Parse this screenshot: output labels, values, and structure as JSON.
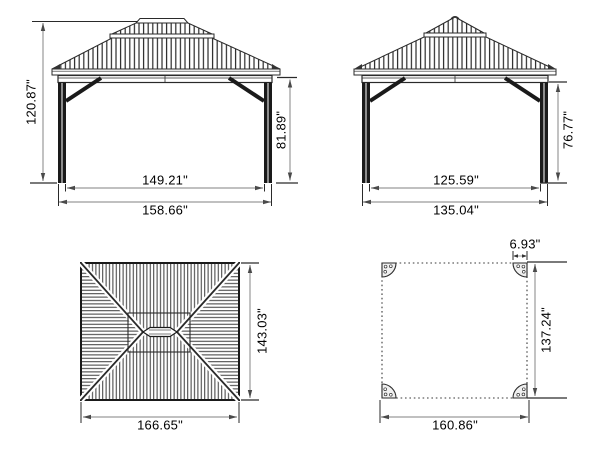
{
  "title": "Gazebo dimension drawing (four orthographic views)",
  "views": {
    "front": {
      "name": "front elevation",
      "total_height": "120.87\"",
      "post_height": "81.89\"",
      "inner_width": "149.21\"",
      "outer_width": "158.66\""
    },
    "side": {
      "name": "side elevation",
      "post_height": "76.77\"",
      "inner_width": "125.59\"",
      "outer_width": "135.04\""
    },
    "roof": {
      "name": "roof plan",
      "depth": "143.03\"",
      "width": "166.65\""
    },
    "base": {
      "name": "base / footprint plan",
      "corner_plate": "6.93\"",
      "depth": "137.24\"",
      "width": "160.86\""
    }
  },
  "colors": {
    "background": "#ffffff",
    "line": "#1a1a1a",
    "dimension_line": "#9a9a9a",
    "arrow": "#4a4a4a",
    "text": "#000000"
  }
}
